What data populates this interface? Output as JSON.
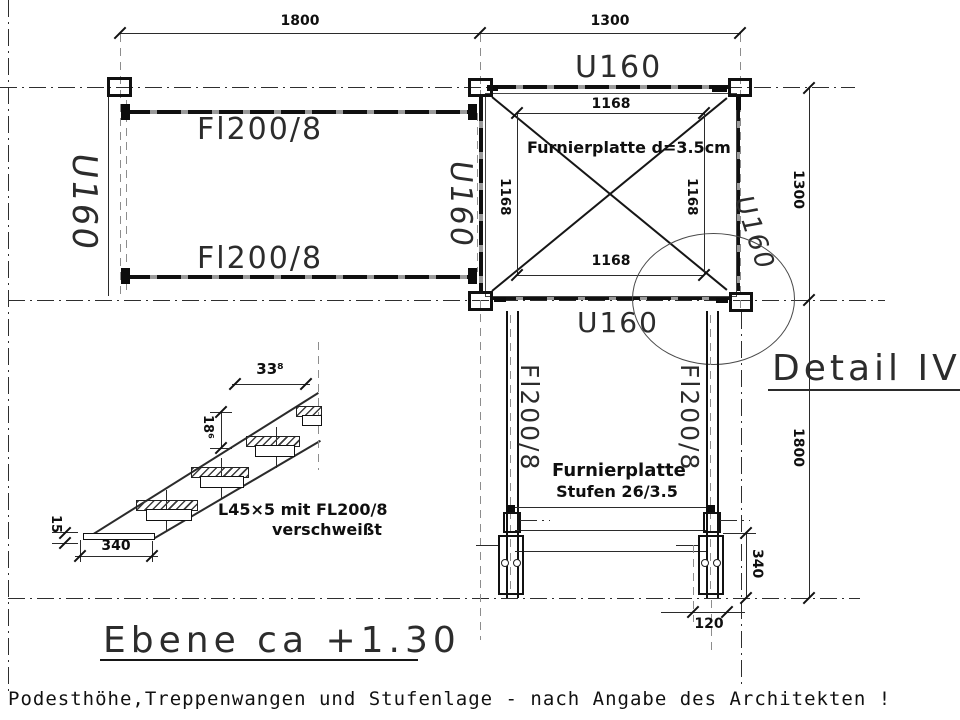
{
  "titles": {
    "detail": "Detail IV",
    "level": "Ebene ca +1.30"
  },
  "footer": {
    "note": "Podesthöhe,Treppenwangen und Stufenlage - nach Angabe des Architekten !"
  },
  "profiles": {
    "u160": "U160",
    "fl200": "Fl200/8"
  },
  "platform": {
    "plate_note": "Furnierplatte d=3.5cm",
    "dim_inner": "1168"
  },
  "stairs": {
    "plate_note_line1": "Furnierplatte",
    "plate_note_line2": "Stufen 26/3.5"
  },
  "dims": {
    "top_left": "1800",
    "top_right": "1300",
    "right_upper": "1300",
    "right_lower": "1800",
    "base_height": "340",
    "base_width": "120"
  },
  "stair_detail": {
    "dim_run": "33⁸",
    "dim_rise": "18⁶",
    "dim_thickness": "15",
    "dim_width": "340",
    "weld_note_line1": "L45×5 mit FL200/8",
    "weld_note_line2": "verschweißt"
  },
  "colors": {
    "line": "#1a1a1a",
    "hidden_gray": "#8d8d8d",
    "background": "#ffffff"
  }
}
